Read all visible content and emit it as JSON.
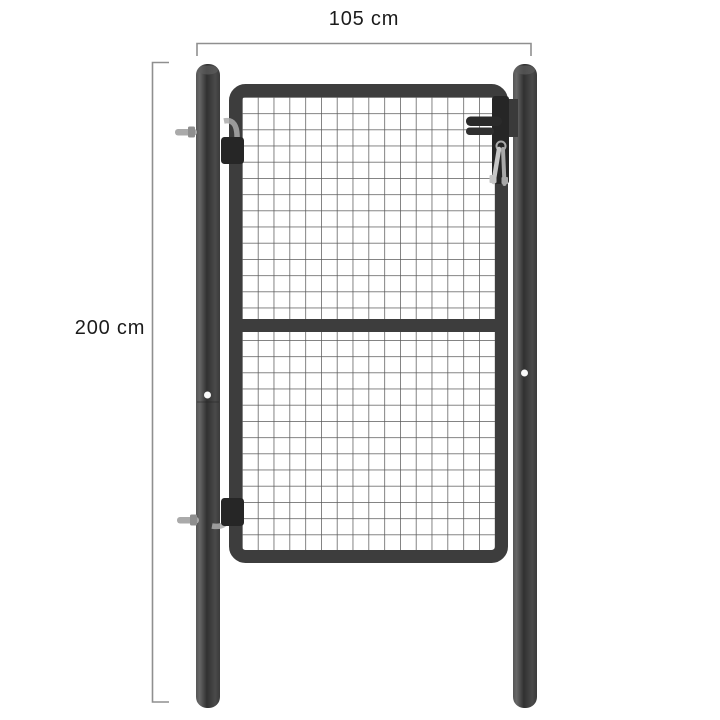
{
  "image": {
    "description": "Product dimension diagram of a grey steel mesh garden gate hung between two round posts, with a lock, handle and keys",
    "background": "#ffffff"
  },
  "dimensions": {
    "width": {
      "label": "105 cm"
    },
    "height": {
      "label": "200 cm"
    }
  },
  "gate": {
    "parts": [
      "left-post",
      "right-post",
      "gate-frame",
      "wire-mesh",
      "middle-rail",
      "top-hinge",
      "bottom-hinge",
      "lock-plate",
      "door-handle",
      "keys"
    ]
  },
  "colors": {
    "background": "#ffffff",
    "frame": "#3d3d3d",
    "meshWire": "#5a5a5a",
    "postDark": "#303030",
    "postLight": "#636363",
    "hardwareDark": "#262626",
    "hardwareSilver": "#aaaaaa",
    "dimensionLine": "#8f8f8f",
    "labelText": "#1b1b1b"
  }
}
